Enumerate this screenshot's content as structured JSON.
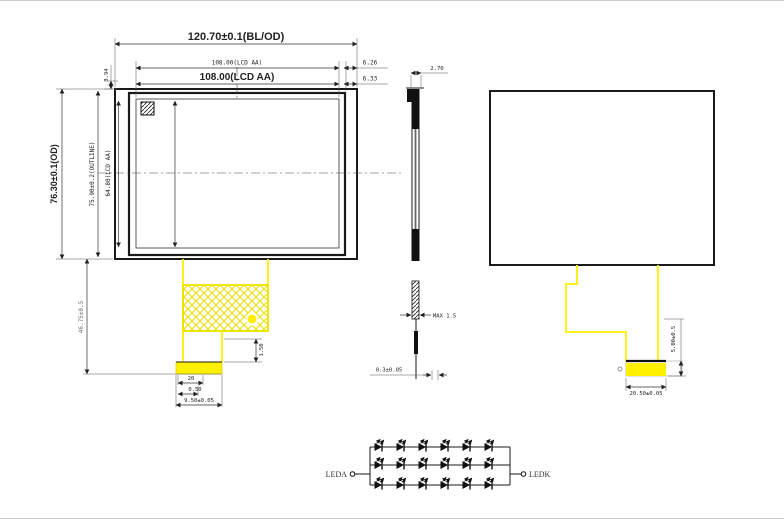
{
  "colors": {
    "fpc-yellow": "#FFF000",
    "line": "#1A1A1A",
    "dim": "#333333",
    "bg": "#FFFFFF"
  },
  "drawing": {
    "front_view": {
      "dim_outer_width": "120.70±0.1(BL/OD)",
      "dim_aa_width_small": "108.00(LCD AA)",
      "dim_aa_width_bold": "108.00(LCD AA)",
      "dim_right_offset_top": "6.26",
      "dim_right_offset_bottom": "6.33",
      "dim_top_offset": "3.94",
      "dim_outer_height": "76.30±0.1(OD)",
      "dim_outline_height": "75.90±0.2(OUTLINE)",
      "dim_aa_height": "64.80(LCD AA)",
      "dim_fpc_length": "46.75±0.5",
      "dim_connector_gap": "1.50",
      "dim_pin_count": "20",
      "dim_pin_pitch": "0.50",
      "dim_connector_width": "9.50±0.05"
    },
    "side_view": {
      "dim_thickness": "2.70",
      "dim_fpc_max": "MAX 1.5",
      "dim_film": "0.3±0.05"
    },
    "rear_view": {
      "dim_stiffener_height": "5.00±0.5",
      "dim_connector_width": "20.50±0.05"
    },
    "led_circuit": {
      "anode_label": "LEDA",
      "cathode_label": "LEDK",
      "rows": 3,
      "leds_per_row": 6
    }
  }
}
